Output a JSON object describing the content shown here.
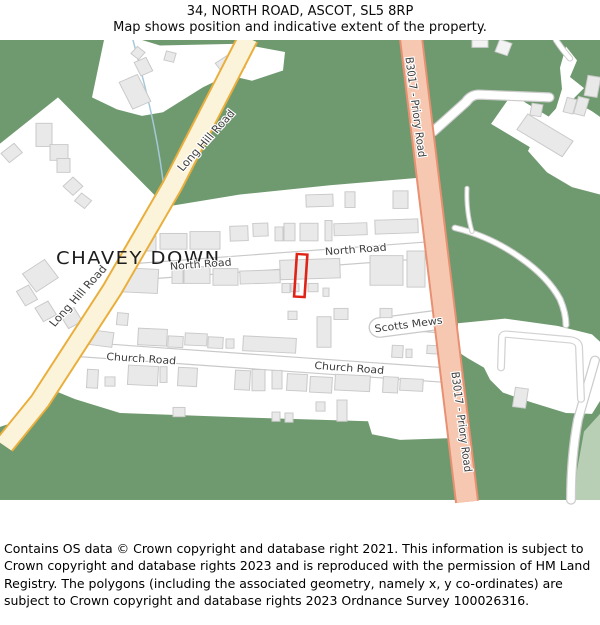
{
  "header": {
    "line1": "34, NORTH ROAD, ASCOT, SL5 8RP",
    "line2": "Map shows position and indicative extent of the property."
  },
  "map": {
    "place_label": "CHAVEY DOWN",
    "road_labels": {
      "long_hill_road": "Long Hill Road",
      "north_road": "North Road",
      "church_road": "Church Road",
      "scotts_mews": "Scotts Mews",
      "b3017_priory_road": "B3017 - Priory Road"
    },
    "property_outline": {
      "description": "red rectangle marking 34 North Road",
      "color": "#e02317"
    },
    "colors": {
      "woodland_green": "#6f9a6f",
      "pale_green_field": "#b9cfb5",
      "minor_road_yellow_fill": "#fcf4da",
      "minor_road_yellow_casing": "#e9ae3c",
      "b_road_salmon_fill": "#f7c8b1",
      "b_road_salmon_casing": "#e89072",
      "building_fill": "#e9e9e9",
      "building_stroke": "#c9c9c9",
      "white_area": "#ffffff",
      "road_casing_grey": "#cccccc",
      "stream_blue": "#a5c8d8"
    }
  },
  "footer": {
    "text": "Contains OS data © Crown copyright and database right 2021. This information is subject to Crown copyright and database rights 2023 and is reproduced with the permission of HM Land Registry. The polygons (including the associated geometry, namely x, y co-ordinates) are subject to Crown copyright and database rights 2023 Ordnance Survey 100026316."
  }
}
